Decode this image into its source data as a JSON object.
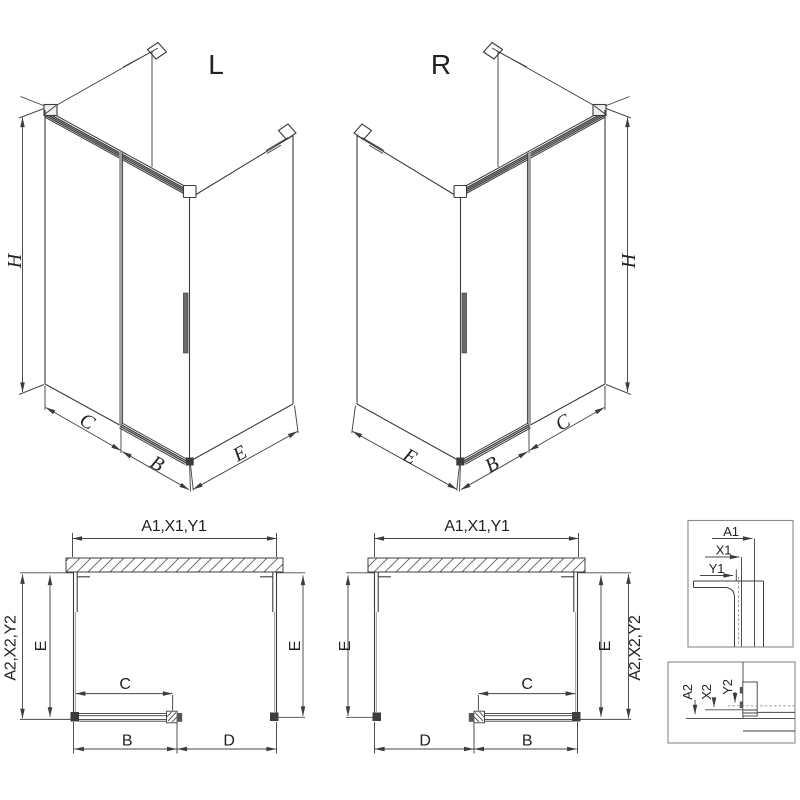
{
  "views": {
    "iso_left": {
      "title": "L",
      "dims": {
        "h": "H",
        "c": "C",
        "b": "B",
        "e": "E"
      }
    },
    "iso_right": {
      "title": "R",
      "dims": {
        "h": "H",
        "e": "E",
        "b": "B",
        "c": "C"
      }
    },
    "plan_left": {
      "dims": {
        "a1": "A1,X1,Y1",
        "a2": "A2,X2,Y2",
        "e_left": "E",
        "e_right": "E",
        "c": "C",
        "b": "B",
        "d": "D"
      }
    },
    "plan_right": {
      "dims": {
        "a1": "A1,X1,Y1",
        "a2": "A2,X2,Y2",
        "e_left": "E",
        "e_right": "E",
        "c": "C",
        "d": "D",
        "b": "B"
      }
    },
    "detail_top": {
      "dims": {
        "a1": "A1",
        "x1": "X1",
        "y1": "Y1"
      }
    },
    "detail_bottom": {
      "dims": {
        "a2": "A2",
        "x2": "X2",
        "y2": "Y2"
      }
    }
  },
  "colors": {
    "line": "#3c3c3c",
    "dim_line": "#474747",
    "light_line": "#9e9e9e",
    "box_border": "#8a8a8a",
    "text": "#222222",
    "background": "#ffffff"
  }
}
